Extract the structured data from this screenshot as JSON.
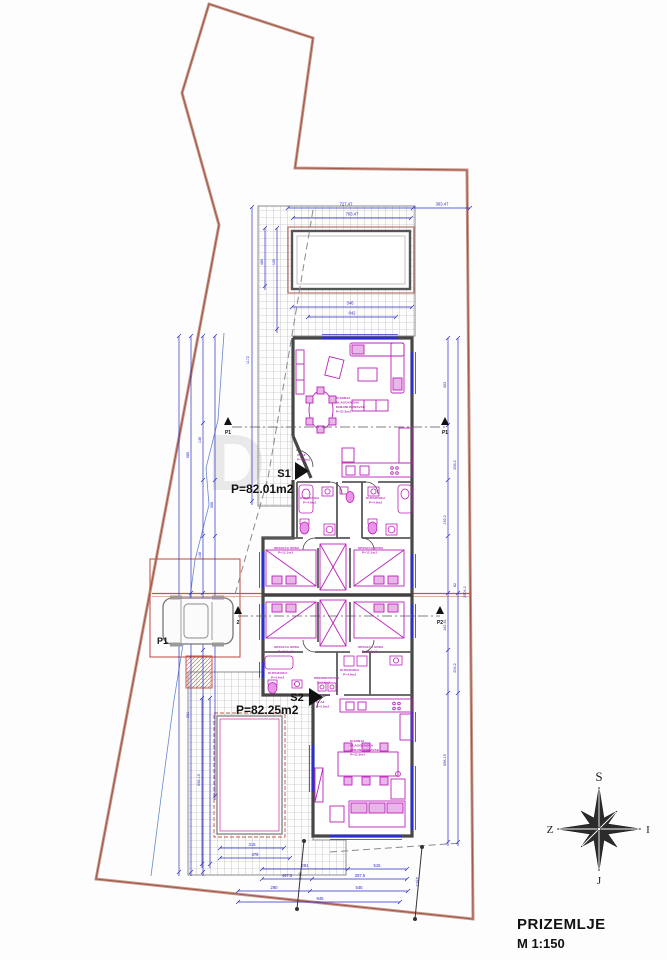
{
  "drawing": {
    "floor_label": "PRIZEMLJE",
    "scale_label": "M 1:150",
    "watermark": "DUX"
  },
  "units": {
    "s1": {
      "code": "S1",
      "area": "P=82.01m2"
    },
    "s2": {
      "code": "S2",
      "area": "P=82.25m2"
    }
  },
  "parking": {
    "label": "P1"
  },
  "compass": {
    "north": "S",
    "south": "J",
    "east": "I",
    "west": "Z"
  },
  "sections": {
    "p1": "P1",
    "p2": "P2",
    "p2_alt": "2"
  },
  "rooms": {
    "living": [
      "KUHINJA",
      "BLAGOVAONA",
      "DNEVNI BORAVAK",
      "P=32.8m2"
    ],
    "bedroom": [
      "SPAVAĆA SOBA",
      "P=12.1m2"
    ],
    "bath": [
      "KUPAONICA",
      "P=4.6m2"
    ],
    "entry": [
      "ULAZ",
      "P=3.5m2"
    ],
    "hall": [
      "PREDPROSTOR",
      "P=3.6m2"
    ]
  },
  "dims": {
    "top_total": "727.47",
    "top_right": "363.47",
    "pool_width": "703.47",
    "below_pool_a": "346",
    "below_pool_b": "842",
    "b1": "315",
    "b2": "379",
    "b3a": "291",
    "b3b": "515",
    "b4a": "467.5",
    "b4b": "287.5",
    "b5a": "290",
    "b5b": "545",
    "b6": "945",
    "diag_a": "436.2",
    "diag_b": "90.2",
    "l_1": "1172",
    "l_2": "960",
    "l_3": "585",
    "l_4": "291",
    "l_5": "135",
    "l_6": "146",
    "l_7": "74",
    "l_8": "306",
    "l_9": "480",
    "l_10": "120",
    "t_v": "658.19",
    "r_1": "303",
    "r_2": "256.2",
    "r_3": "139.2",
    "r_4": "82",
    "r_5": "162.61",
    "r_6": "204.2",
    "r_7": "658.19",
    "r_8": "2904.2"
  },
  "colors": {
    "dim_blue": "#2b2bc4",
    "furniture_magenta": "#bb22bb",
    "boundary_red": "#a2584a",
    "wall_gray": "#474747"
  }
}
